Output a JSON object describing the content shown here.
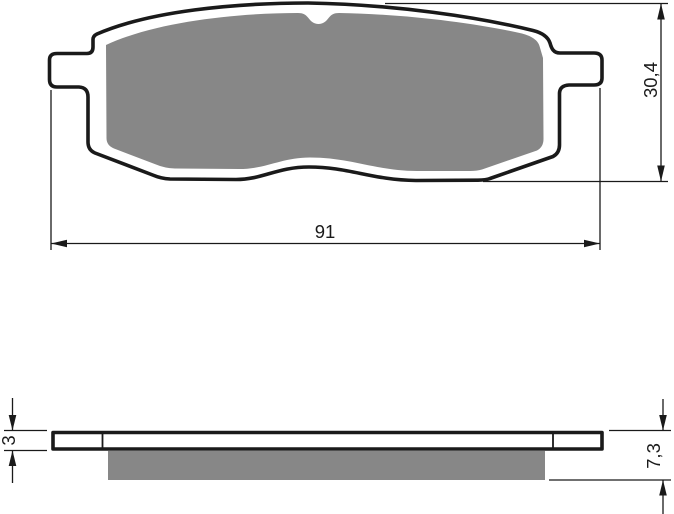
{
  "drawing": {
    "kind": "technical-drawing",
    "subject": "brake-pad-two-views",
    "colors": {
      "line": "#1a1a1a",
      "friction_material": "#878787",
      "backing_plate": "#ffffff",
      "background": "#ffffff"
    },
    "front_view": {
      "name": "front-view",
      "dimensions": {
        "overall_width": {
          "label": "91"
        },
        "overall_height": {
          "label": "30,4"
        }
      }
    },
    "side_view": {
      "name": "side-profile-view",
      "dimensions": {
        "plate_thickness": {
          "label": "3"
        },
        "total_thickness": {
          "label": "7,3"
        }
      }
    }
  }
}
